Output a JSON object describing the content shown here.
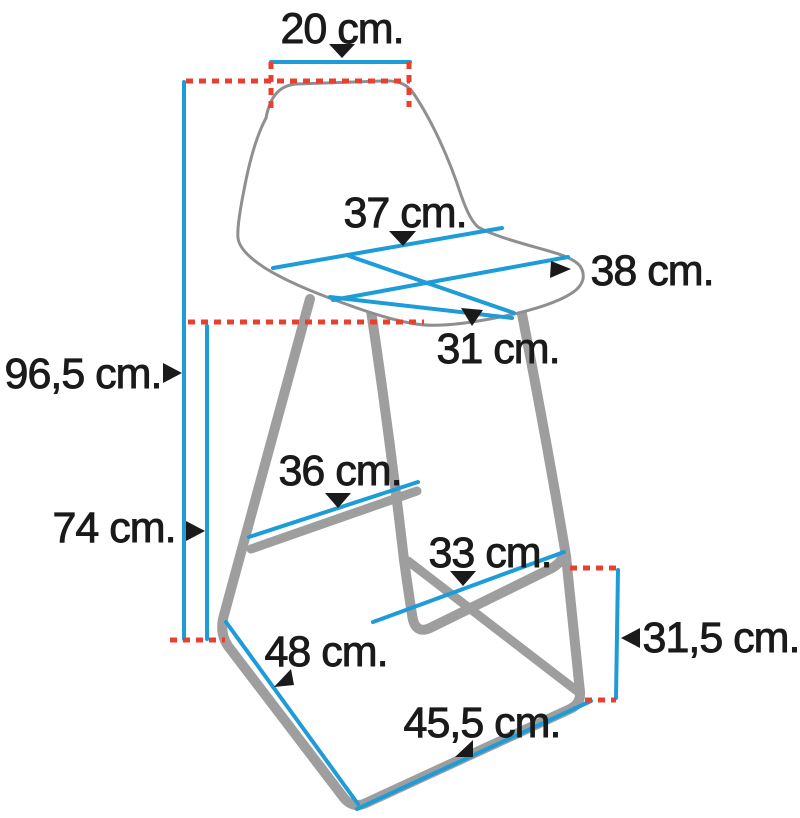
{
  "diagram": {
    "labels": {
      "backrest_top_width": "20 cm.",
      "seat_width": "37 cm.",
      "seat_depth": "38 cm.",
      "seat_front_width": "31 cm.",
      "total_height": "96,5 cm.",
      "seat_height": "74 cm.",
      "footrest_rear_width": "36 cm.",
      "footrest_front_width": "33 cm.",
      "base_side_length": "48 cm.",
      "base_front_length": "45,5 cm.",
      "footrest_to_floor_height": "31,5 cm."
    },
    "colors": {
      "dimension_line": "#1e9cd8",
      "reference_dashed_line": "#e8402e",
      "frame_gray": "#9e9e9e",
      "shell_outline_gray": "#8f8f8f",
      "label_text": "#1a1a1a",
      "background": "#ffffff"
    }
  }
}
